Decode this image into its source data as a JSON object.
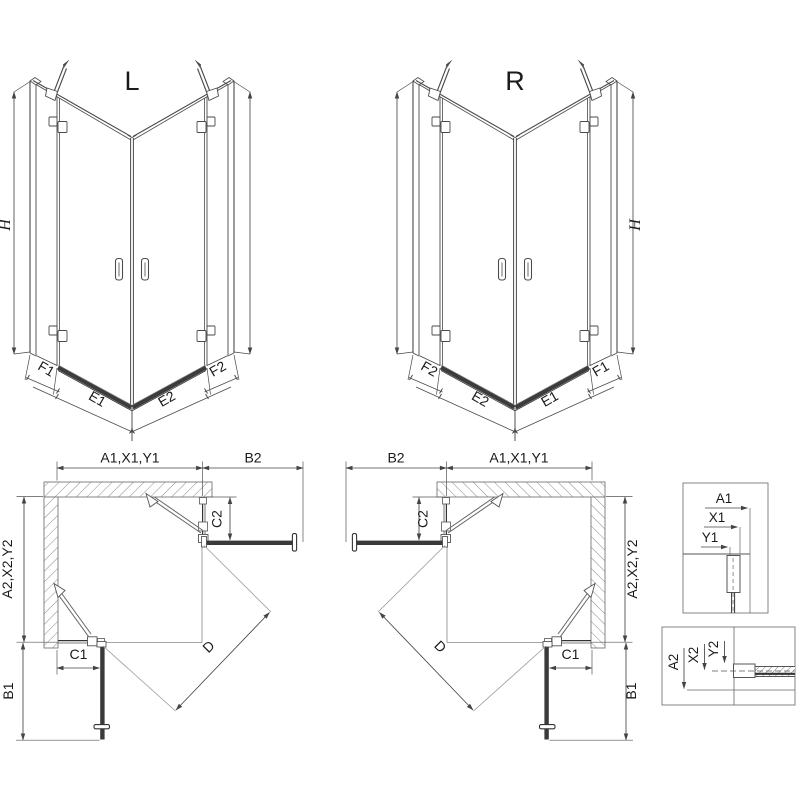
{
  "iso_left": {
    "label": "L",
    "height_label": "H",
    "segments": [
      "F1",
      "E1",
      "E2",
      "F2"
    ]
  },
  "iso_right": {
    "label": "R",
    "height_label": "H",
    "segments": [
      "F2",
      "E2",
      "E1",
      "F1"
    ]
  },
  "plan_left": {
    "width_top": "A1,X1,Y1",
    "width_side": "B2",
    "door_c2": "C2",
    "height_side": "A2,X2,Y2",
    "width_c1": "C1",
    "height_b1": "B1",
    "diagonal": "D"
  },
  "plan_right": {
    "width_top": "A1,X1,Y1",
    "width_side": "B2",
    "door_c2": "C2",
    "height_side": "A2,X2,Y2",
    "width_c1": "C1",
    "height_b1": "B1",
    "diagonal": "D"
  },
  "detail_top": {
    "a": "A1",
    "x": "X1",
    "y": "Y1"
  },
  "detail_bottom": {
    "a": "A2",
    "x": "X2",
    "y": "Y2"
  },
  "colors": {
    "line": "#4a4a4a",
    "dark_bar": "#3a3a3a",
    "dim": "#444444",
    "hatch": "#8a8a8a",
    "background": "#ffffff"
  }
}
